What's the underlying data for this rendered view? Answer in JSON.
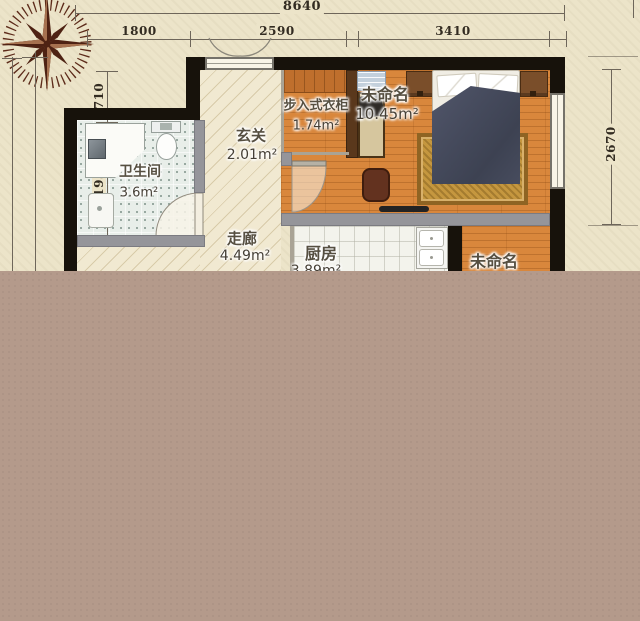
{
  "plan": {
    "dimensions": {
      "top_total": "8640",
      "top_segment_1": "1800",
      "top_segment_2": "2590",
      "top_segment_3": "3410",
      "left_segment_1": "710",
      "left_segment_2": "1930",
      "right_segment_1": "2670"
    },
    "rooms": {
      "bathroom": {
        "name": "卫生间",
        "area": "3.6m²"
      },
      "entry": {
        "name": "玄关",
        "area": "2.01m²"
      },
      "corridor": {
        "name": "走廊",
        "area": "4.49m²"
      },
      "closet": {
        "name": "步入式衣柜",
        "area": "1.74m²"
      },
      "bedroom": {
        "name": "未命名",
        "area": "10.45m²"
      },
      "kitchen": {
        "name": "厨房",
        "area": "3.89m²"
      },
      "bottom_right_room": {
        "name": "未命名"
      }
    },
    "icons": {
      "compass": "compass-rose"
    },
    "colors": {
      "parchment": "#ece4c9",
      "blank_overlay": "#b49a8b",
      "wall": "#17120b",
      "partition_gray": "#95959a",
      "wood_floor": "#d9873c",
      "bath_tile": "#e8eee9",
      "kitchen_tile": "#f3f3ec",
      "corridor_floor": "#f1e9d1",
      "bed_blanket": "#454a5c",
      "rug": "#c5973f",
      "compass": "#4e2213",
      "dimension_text": "#332c22"
    }
  }
}
